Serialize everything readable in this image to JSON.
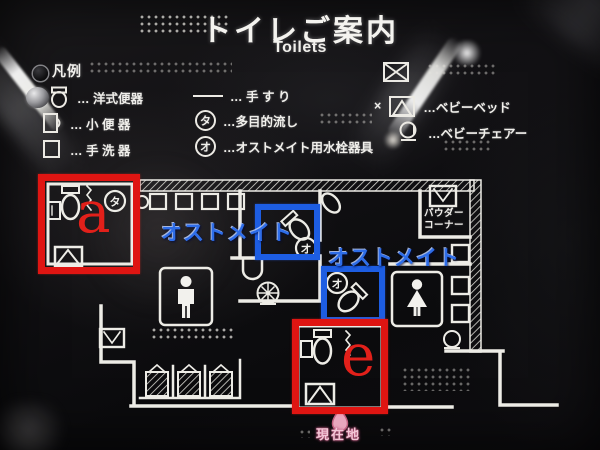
{
  "header": {
    "title_ja": "トイレご案内",
    "title_en": "Toilets"
  },
  "legend": {
    "header": "凡例",
    "col1": [
      {
        "icon": "western-toilet-icon",
        "label": "… 洋式便器"
      },
      {
        "icon": "urinal-icon",
        "label": "… 小 便 器"
      },
      {
        "icon": "hand-basin-icon",
        "label": "… 手 洗 器"
      }
    ],
    "col2": [
      {
        "icon": "handrail-icon",
        "label": "… 手 す り"
      },
      {
        "icon": "circle-ta-icon",
        "glyph": "タ",
        "label": "…多目的流し"
      },
      {
        "icon": "circle-o-icon",
        "glyph": "オ",
        "label": "…オストメイト用水栓器具"
      }
    ],
    "col3": [
      {
        "icon": "baby-bed-x-icon",
        "prefix": "",
        "label": ""
      },
      {
        "icon": "baby-bed-icon",
        "prefix": "×",
        "label": "…ベビーベッド"
      },
      {
        "icon": "baby-chair-icon",
        "prefix": "",
        "label": "…ベビーチェアー"
      }
    ]
  },
  "map": {
    "glyph_ta": "タ",
    "glyph_o": "オ",
    "powder_corner_line1": "パウダー",
    "powder_corner_line2": "コーナー",
    "current_location": "現在地"
  },
  "annotations": {
    "box_a_label": "a",
    "box_e_label": "e",
    "ostomate_label_1": "オストメイト",
    "ostomate_label_2": "オストメイト"
  },
  "colors": {
    "annotation_red": "#df1512",
    "annotation_blue": "#1d5de2",
    "map_line": "#edece6",
    "marker_pink": "#e8a6bd"
  }
}
